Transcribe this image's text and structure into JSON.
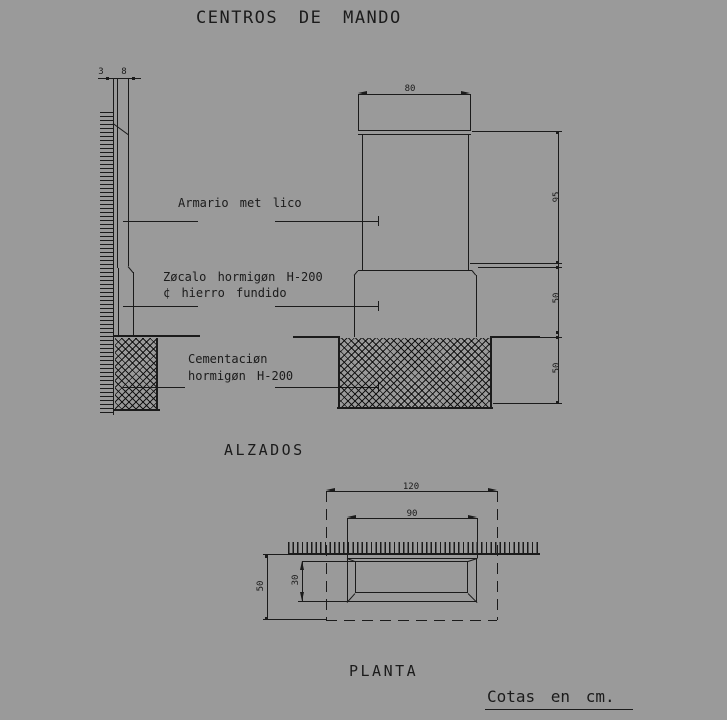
{
  "colors": {
    "background": "#9a9a9a",
    "line": "#1b1b1b"
  },
  "title": "CENTROS DE MANDO",
  "views": {
    "alzados": {
      "caption": "ALZADOS",
      "labels": {
        "armario": "Armario met lico",
        "zocalo_line1": "Zøcalo hormigøn H-200",
        "zocalo_line2": "¢ hierro fundido",
        "cementacion_line1": "Cementaciøn",
        "cementacion_line2": "hormigøn H-200"
      },
      "dims": {
        "wall_gap": "3",
        "cabinet_depth": "8",
        "cabinet_width": "80",
        "cabinet_height": "95",
        "zocalo_height": "50",
        "foundation_height": "50"
      }
    },
    "planta": {
      "caption": "PLANTA",
      "dims": {
        "foundation_width": "120",
        "cabinet_width": "90",
        "cabinet_depth": "30",
        "foundation_depth": "50"
      }
    }
  },
  "footer": {
    "units_note": "Cotas en cm."
  }
}
